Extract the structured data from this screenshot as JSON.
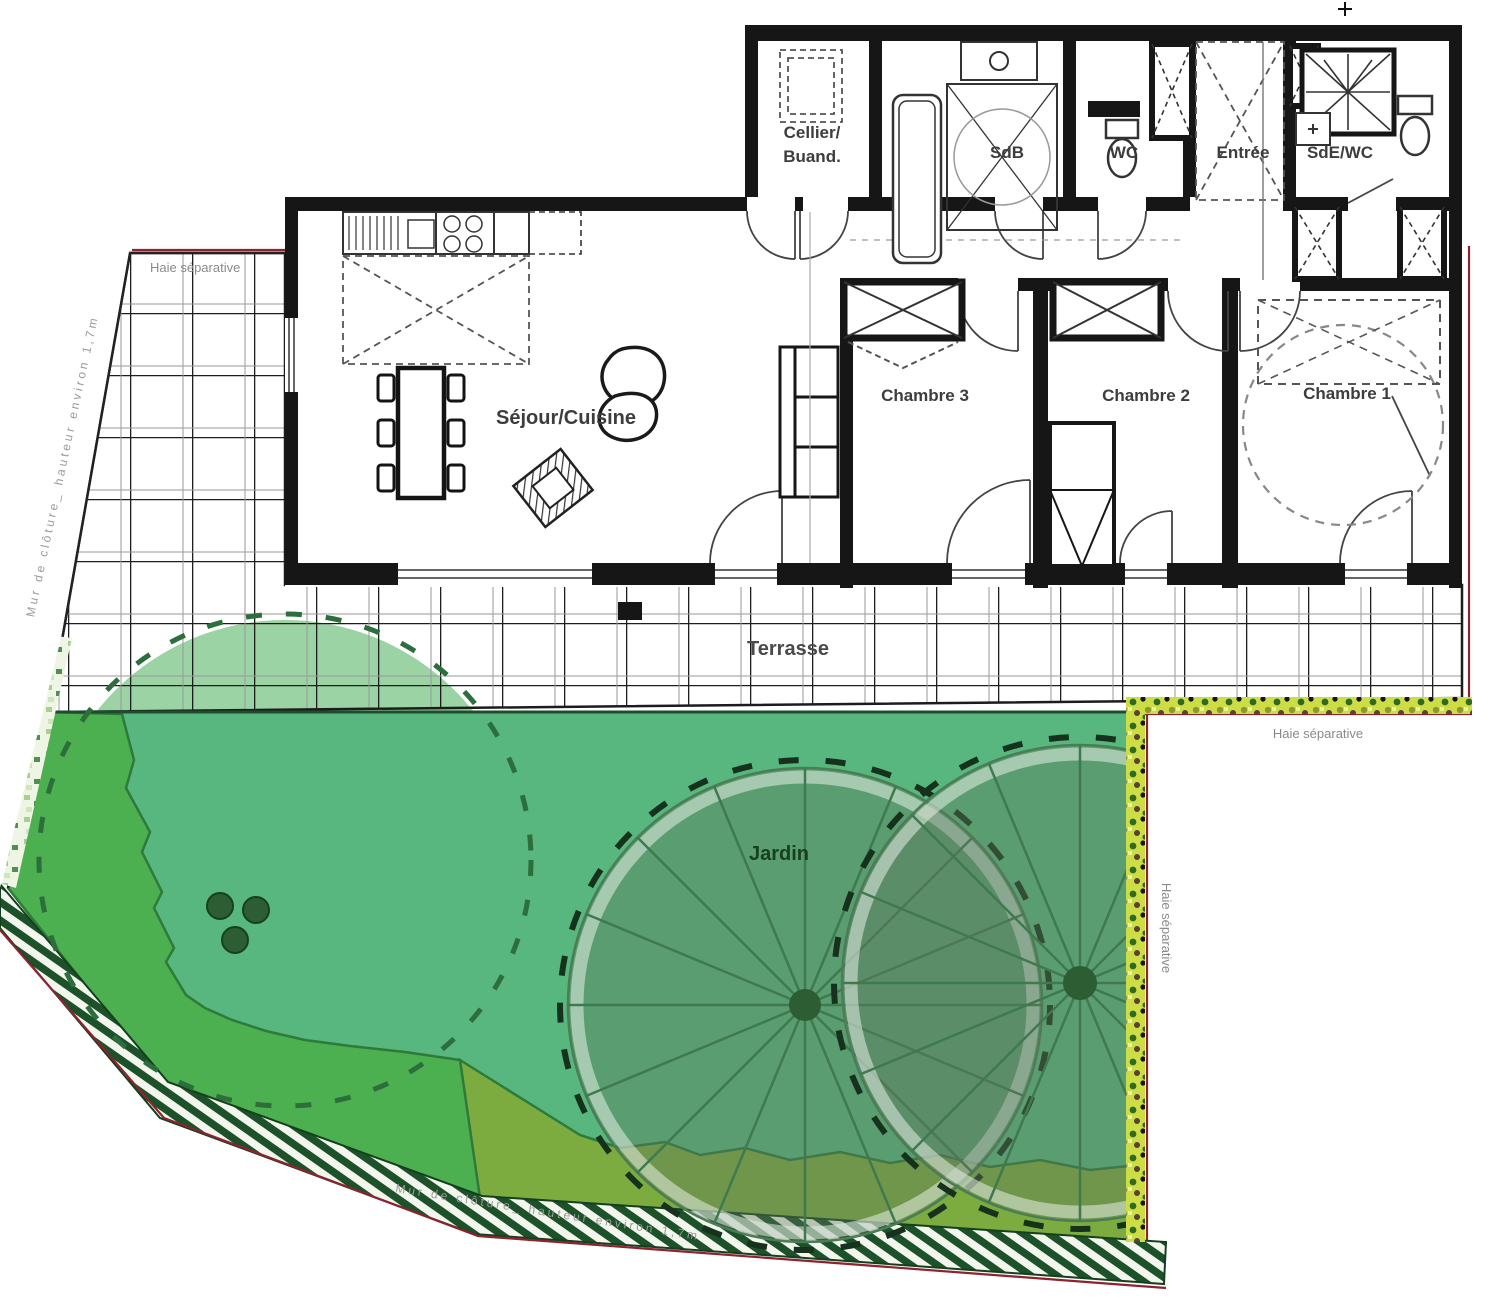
{
  "plan": {
    "rooms": {
      "cellier_line1": "Cellier/",
      "cellier_line2": "Buand.",
      "sdb": "SdB",
      "wc": "WC",
      "entree": "Entrée",
      "sde_wc": "SdE/WC",
      "sejour_cuisine": "Séjour/Cuisine",
      "chambre1": "Chambre 1",
      "chambre2": "Chambre 2",
      "chambre3": "Chambre 3"
    },
    "outdoor": {
      "terrasse": "Terrasse",
      "jardin": "Jardin",
      "haie_top_left": "Haie séparative",
      "haie_right_horizontal": "Haie séparative",
      "haie_right_vertical": "Haie séparative",
      "mur_left": "Mur de clôture_ hauteur environ 1,7m",
      "mur_bottom": "Mur de clôture_ hauteur environ 1,7m"
    },
    "colors": {
      "wall": "#161616",
      "garden_base": "#57b77e",
      "garden_left_strip": "#4cb050",
      "garden_bottom_strip": "#7cac40",
      "tree_light": "#9cd3a4",
      "tree_canopy": "rgba(96,117,96,0.40)",
      "tree_line": "#3f7a4f",
      "hedge_yellow": "#cddd45",
      "hatch_green": "#1c512a",
      "boundary_red": "#8e2230",
      "label_grey": "#8a8a8a",
      "room_label": "#3d3d3d"
    }
  }
}
